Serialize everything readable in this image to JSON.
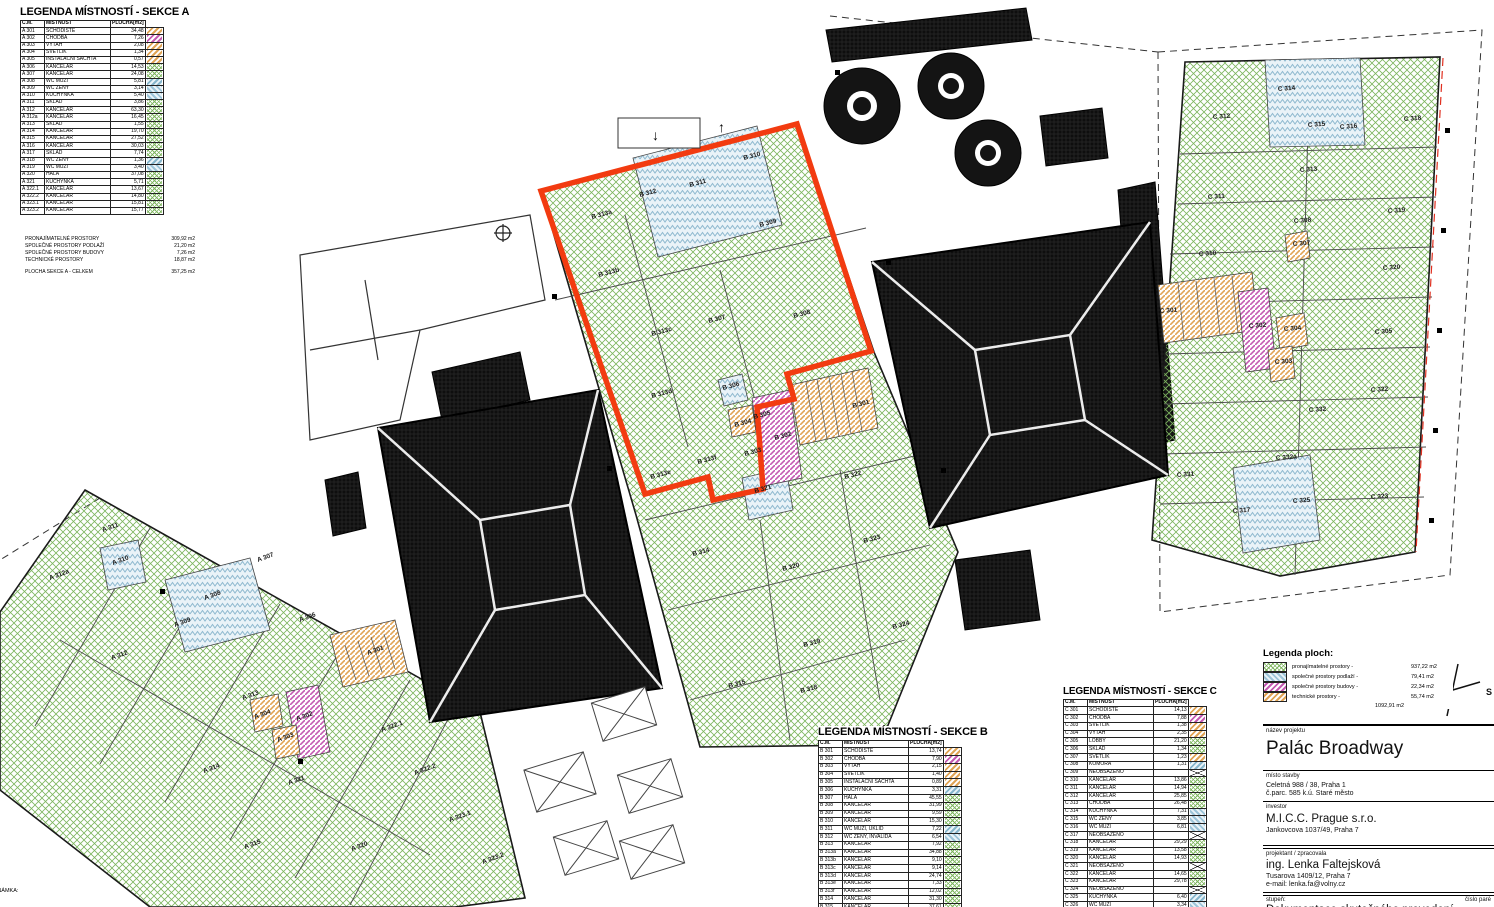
{
  "legend_a": {
    "title": "LEGENDA MÍSTNOSTÍ - SEKCE A",
    "columns": [
      "Č.M.",
      "MÍSTNOST",
      "PLOCHA[m2]"
    ],
    "rows": [
      [
        "A 301",
        "SCHODIŠTĚ",
        "34,48",
        "orange"
      ],
      [
        "A 302",
        "CHODBA",
        "7,26",
        "purple"
      ],
      [
        "A 303",
        "VÝTAH",
        "2,08",
        "orange"
      ],
      [
        "A 304",
        "SVĚTLÍK",
        "1,34",
        "orange"
      ],
      [
        "A 305",
        "INSTALAČNÍ ŠACHTA",
        "0,57",
        "orange"
      ],
      [
        "A 306",
        "KANCELÁŘ",
        "14,53",
        "green"
      ],
      [
        "A 307",
        "KANCELÁŘ",
        "24,08",
        "green"
      ],
      [
        "A 308",
        "WC MUŽI",
        "5,81",
        "blue"
      ],
      [
        "A 309",
        "WC ŽENY",
        "3,14",
        "bluechev"
      ],
      [
        "A 310",
        "KUCHYŇKA",
        "5,40",
        "bluechev"
      ],
      [
        "A 311",
        "SKLAD",
        "3,86",
        "green"
      ],
      [
        "A 312",
        "KANCELÁŘ",
        "63,30",
        "green"
      ],
      [
        "A 312a",
        "KANCELÁŘ",
        "16,45",
        "green"
      ],
      [
        "A 313",
        "SKLAD",
        "1,55",
        "green"
      ],
      [
        "A 314",
        "KANCELÁŘ",
        "19,70",
        "green"
      ],
      [
        "A 315",
        "KANCELÁŘ",
        "27,52",
        "green"
      ],
      [
        "A 316",
        "KANCELÁŘ",
        "30,03",
        "green"
      ],
      [
        "A 317",
        "SKLAD",
        "7,74",
        "green"
      ],
      [
        "A 318",
        "WC ŽENY",
        "1,36",
        "blue"
      ],
      [
        "A 319",
        "WC MUŽI",
        "3,40",
        "bluechev"
      ],
      [
        "A 320",
        "HALA",
        "37,08",
        "green"
      ],
      [
        "A 321",
        "KUCHYŇKA",
        "5,71",
        "green"
      ],
      [
        "A 322.1",
        "KANCELÁŘ",
        "13,67",
        "green"
      ],
      [
        "A 322.2",
        "KANCELÁŘ",
        "14,80",
        "green"
      ],
      [
        "A 323.1",
        "KANCELÁŘ",
        "15,81",
        "green"
      ],
      [
        "A 323.2",
        "KANCELÁŘ",
        "15,77",
        "green"
      ]
    ],
    "summary": [
      [
        "PRONAJÍMATELNÉ PROSTORY",
        "309,92 m2"
      ],
      [
        "SPOLEČNÉ PROSTORY PODLAŽÍ",
        "21,20 m2"
      ],
      [
        "SPOLEČNÉ PROSTORY BUDOVY",
        "7,26 m2"
      ],
      [
        "TECHNICKÉ PROSTORY",
        "18,87 m2"
      ]
    ],
    "total": [
      "PLOCHA SEKCE A - CELKEM",
      "357,25 m2"
    ]
  },
  "legend_b": {
    "title": "LEGENDA MÍSTNOSTÍ - SEKCE B",
    "columns": [
      "Č.M.",
      "MÍSTNOST",
      "PLOCHA[m2]"
    ],
    "rows": [
      [
        "B 301",
        "SCHODIŠTĚ",
        "13,74",
        "orange"
      ],
      [
        "B 302",
        "CHODBA",
        "7,90",
        "purple"
      ],
      [
        "B 303",
        "VÝTAH",
        "2,15",
        "orange"
      ],
      [
        "B 304",
        "SVĚTLÍK",
        "1,40",
        "orange"
      ],
      [
        "B 305",
        "INSTALAČNÍ ŠACHTA",
        "0,89",
        "orange"
      ],
      [
        "B 306",
        "KUCHYŇKA",
        "3,31",
        "blue"
      ],
      [
        "B 307",
        "HALA",
        "45,55",
        "green"
      ],
      [
        "B 308",
        "KANCELÁŘ",
        "31,99",
        "green"
      ],
      [
        "B 309",
        "KANCELÁŘ",
        "9,59",
        "green"
      ],
      [
        "B 310",
        "KANCELÁŘ",
        "15,30",
        "green"
      ],
      [
        "B 311",
        "WC MUŽI, ÚKLID",
        "7,22",
        "blue"
      ],
      [
        "B 312",
        "WC ŽENY, INVALIDA",
        "6,54",
        "bluechev"
      ],
      [
        "B 313",
        "KANCELÁŘ",
        "7,92",
        "green"
      ],
      [
        "B 313a",
        "KANCELÁŘ",
        "34,88",
        "green"
      ],
      [
        "B 313b",
        "KANCELÁŘ",
        "9,10",
        "green"
      ],
      [
        "B 313c",
        "KANCELÁŘ",
        "9,14",
        "green"
      ],
      [
        "B 313d",
        "KANCELÁŘ",
        "24,74",
        "green"
      ],
      [
        "B 313e",
        "KANCELÁŘ",
        "7,33",
        "green"
      ],
      [
        "B 313f",
        "KANCELÁŘ",
        "12,02",
        "green"
      ],
      [
        "B 314",
        "KANCELÁŘ",
        "31,30",
        "green"
      ],
      [
        "B 315",
        "KANCELÁŘ",
        "37,61",
        "green"
      ]
    ]
  },
  "legend_c": {
    "title": "LEGENDA MÍSTNOSTÍ - SEKCE C",
    "columns": [
      "Č.M.",
      "MÍSTNOST",
      "PLOCHA[m2]"
    ],
    "rows": [
      [
        "C 301",
        "SCHODIŠTĚ",
        "14,13",
        "orange"
      ],
      [
        "C 302",
        "CHODBA",
        "7,88",
        "purple"
      ],
      [
        "C 303",
        "SVĚTLÍK",
        "1,38",
        "orange"
      ],
      [
        "C 304",
        "VÝTAH",
        "2,35",
        "orange"
      ],
      [
        "C 305",
        "LOBBY",
        "21,20",
        "green"
      ],
      [
        "C 306",
        "SKLAD",
        "1,34",
        "green"
      ],
      [
        "C 307",
        "SVĚTLÍK",
        "1,23",
        "orange"
      ],
      [
        "C 308",
        "KOMORA",
        "1,31",
        "blue"
      ],
      [
        "C 309",
        "NEOBSAZENO",
        "",
        "none"
      ],
      [
        "C 310",
        "KANCELÁŘ",
        "13,86",
        "green"
      ],
      [
        "C 311",
        "KANCELÁŘ",
        "14,94",
        "green"
      ],
      [
        "C 312",
        "KANCELÁŘ",
        "25,85",
        "green"
      ],
      [
        "C 313",
        "CHODBA",
        "26,48",
        "green"
      ],
      [
        "C 314",
        "KUCHYŇKA",
        "7,31",
        "bluechev"
      ],
      [
        "C 315",
        "WC ŽENY",
        "3,85",
        "bluechev"
      ],
      [
        "C 316",
        "WC MUŽI",
        "6,81",
        "bluechev"
      ],
      [
        "C 317",
        "NEOBSAZENO",
        "",
        "none"
      ],
      [
        "C 318",
        "KANCELÁŘ",
        "29,29",
        "green"
      ],
      [
        "C 319",
        "KANCELÁŘ",
        "13,58",
        "green"
      ],
      [
        "C 320",
        "KANCELÁŘ",
        "14,93",
        "green"
      ],
      [
        "C 321",
        "NEOBSAZENO",
        "",
        "none"
      ],
      [
        "C 322",
        "KANCELÁŘ",
        "14,65",
        "green"
      ],
      [
        "C 323",
        "KANCELÁŘ",
        "29,78",
        "green"
      ],
      [
        "C 324",
        "NEOBSAZENO",
        "",
        "none"
      ],
      [
        "C 325",
        "KUCHYŇKA",
        "6,40",
        "blue"
      ],
      [
        "C 326",
        "WC MUŽI",
        "3,34",
        "bluechev"
      ]
    ]
  },
  "legend_ploch": {
    "title": "Legenda ploch:",
    "items": [
      {
        "label": "pronajímatelné prostory -",
        "value": "937,22 m2",
        "pattern": "green"
      },
      {
        "label": "společné prostory podlaží -",
        "value": "79,41 m2",
        "pattern": "bluechev"
      },
      {
        "label": "společné prostory budovy -",
        "value": "22,34 m2",
        "pattern": "purple"
      },
      {
        "label": "technické prostory -",
        "value": "55,74 m2",
        "pattern": "orange"
      }
    ],
    "total": "1092,91 m2"
  },
  "title_block": {
    "nazev_label": "název projektu",
    "nazev": "Palác Broadway",
    "misto_label": "místo stavby",
    "misto1": "Celetná  988 / 38, Praha 1",
    "misto2": "č.parc. 585  k.ú. Staré město",
    "investor_label": "investor",
    "investor": "M.I.C.C. Prague s.r.o.",
    "investor_addr": "Jankovcova 1037/49, Praha 7",
    "projektant_label": "projektant / zpracovala",
    "projektant": "ing. Lenka Faltejsková",
    "projektant_addr": "Tusarova 1409/12, Praha 7",
    "projektant_email": "e-mail: lenka.fa@volny.cz",
    "stupen_label": "stupeň:",
    "cislo_label": "číslo paré",
    "stupen": "Dokumentace skutečného provedení"
  },
  "compass": {
    "label": "S"
  },
  "note": "POZNÁMKA:",
  "plan": {
    "arrows": [
      "↓",
      "↑"
    ],
    "a": [
      {
        "t": "A 311",
        "x": 103,
        "y": 532
      },
      {
        "t": "A 310",
        "x": 113,
        "y": 565
      },
      {
        "t": "A 312a",
        "x": 50,
        "y": 580
      },
      {
        "t": "A 307",
        "x": 258,
        "y": 562
      },
      {
        "t": "A 308",
        "x": 205,
        "y": 600
      },
      {
        "t": "A 309",
        "x": 175,
        "y": 627
      },
      {
        "t": "A 306",
        "x": 300,
        "y": 622
      },
      {
        "t": "A 312",
        "x": 112,
        "y": 660
      },
      {
        "t": "A 301",
        "x": 368,
        "y": 655
      },
      {
        "t": "A 313",
        "x": 243,
        "y": 700
      },
      {
        "t": "A 304",
        "x": 255,
        "y": 719
      },
      {
        "t": "A 302",
        "x": 297,
        "y": 721
      },
      {
        "t": "A 303",
        "x": 278,
        "y": 742
      },
      {
        "t": "A 322.1",
        "x": 382,
        "y": 732
      },
      {
        "t": "A 322.2",
        "x": 415,
        "y": 775
      },
      {
        "t": "A 314",
        "x": 204,
        "y": 773
      },
      {
        "t": "A 321",
        "x": 289,
        "y": 785
      },
      {
        "t": "A 315",
        "x": 245,
        "y": 849
      },
      {
        "t": "A 320",
        "x": 352,
        "y": 851
      },
      {
        "t": "A 323.1",
        "x": 450,
        "y": 822
      },
      {
        "t": "A 323.2",
        "x": 483,
        "y": 864
      }
    ],
    "b": [
      {
        "t": "B 310",
        "x": 744,
        "y": 160
      },
      {
        "t": "B 311",
        "x": 690,
        "y": 187
      },
      {
        "t": "B 312",
        "x": 640,
        "y": 197
      },
      {
        "t": "B 313a",
        "x": 592,
        "y": 219
      },
      {
        "t": "B 309",
        "x": 760,
        "y": 227
      },
      {
        "t": "B 313b",
        "x": 599,
        "y": 277
      },
      {
        "t": "B 307",
        "x": 709,
        "y": 323
      },
      {
        "t": "B 308",
        "x": 794,
        "y": 318
      },
      {
        "t": "B 313c",
        "x": 652,
        "y": 336
      },
      {
        "t": "B 313d",
        "x": 652,
        "y": 398
      },
      {
        "t": "B 306",
        "x": 723,
        "y": 390
      },
      {
        "t": "B 304",
        "x": 735,
        "y": 427
      },
      {
        "t": "B 305",
        "x": 754,
        "y": 419
      },
      {
        "t": "B 302",
        "x": 775,
        "y": 440
      },
      {
        "t": "B 303",
        "x": 745,
        "y": 456
      },
      {
        "t": "B 301",
        "x": 853,
        "y": 408
      },
      {
        "t": "B 313f",
        "x": 698,
        "y": 464
      },
      {
        "t": "B 313e",
        "x": 651,
        "y": 479
      },
      {
        "t": "B 321",
        "x": 755,
        "y": 493
      },
      {
        "t": "B 322",
        "x": 845,
        "y": 479
      },
      {
        "t": "B 323",
        "x": 864,
        "y": 543
      },
      {
        "t": "B 314",
        "x": 693,
        "y": 556
      },
      {
        "t": "B 320",
        "x": 783,
        "y": 571
      },
      {
        "t": "B 324",
        "x": 893,
        "y": 629
      },
      {
        "t": "B 319",
        "x": 804,
        "y": 647
      },
      {
        "t": "B 315",
        "x": 729,
        "y": 688
      },
      {
        "t": "B 318",
        "x": 801,
        "y": 693
      }
    ],
    "c": [
      {
        "t": "C 312",
        "x": 1213,
        "y": 119
      },
      {
        "t": "C 314",
        "x": 1278,
        "y": 91
      },
      {
        "t": "C 315",
        "x": 1308,
        "y": 127
      },
      {
        "t": "C 316",
        "x": 1340,
        "y": 129
      },
      {
        "t": "C 318",
        "x": 1404,
        "y": 121
      },
      {
        "t": "C 311",
        "x": 1208,
        "y": 199
      },
      {
        "t": "C 313",
        "x": 1300,
        "y": 172
      },
      {
        "t": "C 319",
        "x": 1388,
        "y": 213
      },
      {
        "t": "C 310",
        "x": 1199,
        "y": 256
      },
      {
        "t": "C 308",
        "x": 1294,
        "y": 223
      },
      {
        "t": "C 307",
        "x": 1293,
        "y": 246
      },
      {
        "t": "C 320",
        "x": 1383,
        "y": 270
      },
      {
        "t": "C 301",
        "x": 1160,
        "y": 313
      },
      {
        "t": "C 302",
        "x": 1249,
        "y": 328
      },
      {
        "t": "C 304",
        "x": 1284,
        "y": 331
      },
      {
        "t": "C 303",
        "x": 1275,
        "y": 364
      },
      {
        "t": "C 305",
        "x": 1375,
        "y": 334
      },
      {
        "t": "C 322",
        "x": 1371,
        "y": 392
      },
      {
        "t": "C 332",
        "x": 1309,
        "y": 412
      },
      {
        "t": "C 331",
        "x": 1177,
        "y": 477
      },
      {
        "t": "C 332a",
        "x": 1276,
        "y": 460
      },
      {
        "t": "C 325",
        "x": 1293,
        "y": 503
      },
      {
        "t": "C 317",
        "x": 1233,
        "y": 513
      },
      {
        "t": "C 323",
        "x": 1371,
        "y": 499
      }
    ]
  },
  "colors": {
    "highlight_red": "#f23b10",
    "hatch_green": "#7db55e",
    "hatch_orange": "#e0a455",
    "hatch_purple": "#c45ab2",
    "hatch_blue": "#86b6cc",
    "roof_black": "#0e0e0e"
  }
}
